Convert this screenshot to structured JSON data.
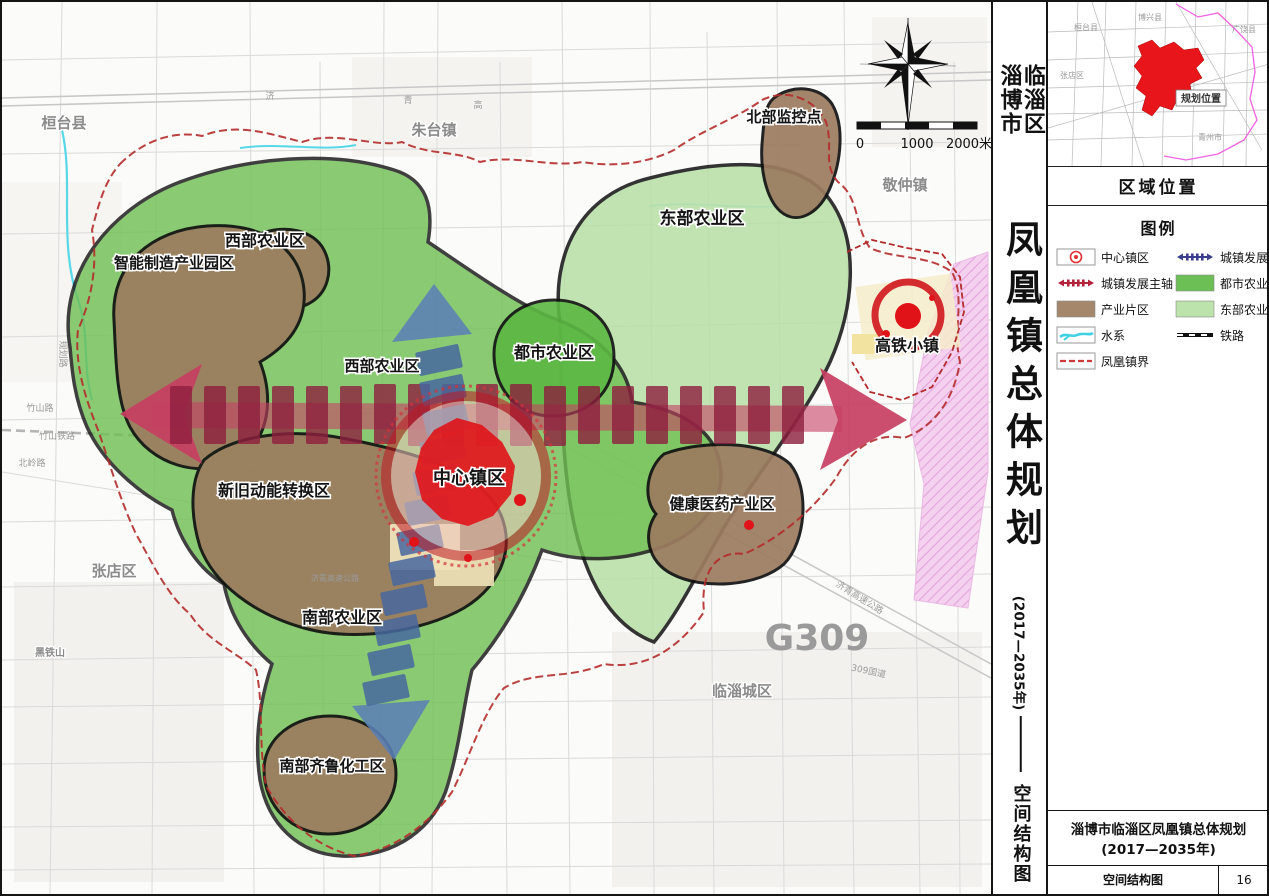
{
  "doc": {
    "region_label_right": "临淄区",
    "region_label_left": "淄博市",
    "main_title": "凤凰镇总体规划",
    "period": "(2017—2035年)",
    "subtitle": "空间结构图"
  },
  "inset": {
    "header": "区域位置",
    "box_label": "规划位置",
    "labels": [
      "桓台县",
      "博兴县",
      "广饶县",
      "张店区",
      "青州市"
    ]
  },
  "legend": {
    "header": "图例",
    "left": [
      {
        "label": "中心镇区",
        "icon": "center-town"
      },
      {
        "label": "城镇发展主轴",
        "icon": "main-axis"
      },
      {
        "label": "产业片区",
        "icon": "industry-zone"
      },
      {
        "label": "水系",
        "icon": "water-system"
      },
      {
        "label": "凤凰镇界",
        "icon": "town-boundary"
      }
    ],
    "right": [
      {
        "label": "城镇发展次轴",
        "icon": "secondary-axis"
      },
      {
        "label": "都市农业区",
        "icon": "urban-agriculture"
      },
      {
        "label": "东部农业区",
        "icon": "east-agriculture"
      },
      {
        "label": "铁路",
        "icon": "railway"
      }
    ]
  },
  "map": {
    "zone_labels": [
      "北部监控点",
      "东部农业区",
      "西部农业区",
      "智能制造产业园区",
      "西部农业区",
      "都市农业区",
      "中心镇区",
      "新旧动能转换区",
      "健康医药产业区",
      "南部农业区",
      "高铁小镇",
      "南部齐鲁化工区"
    ],
    "district_labels": [
      "桓台县",
      "朱台镇",
      "敬仲镇",
      "张店区",
      "临淄城区",
      "黑铁山"
    ],
    "road_labels": [
      "济",
      "青",
      "高",
      "竹山路",
      "竹山铁路",
      "北岭路",
      "规划路",
      "济青高速公路",
      "济青高速公路",
      "G309",
      "309国道"
    ],
    "scale": {
      "zero": "0",
      "mid": "1000",
      "end": "2000米"
    }
  },
  "footer": {
    "title": "淄博市临淄区凤凰镇总体规划(2017—2035年)",
    "map_name": "空间结构图",
    "page": "16"
  },
  "colors": {
    "urban_agriculture": "#6fbf52",
    "east_agriculture": "#b7dfa6",
    "industry_zone": "#9c7c60",
    "main_axis": "#b3243c",
    "secondary_axis": "#3d3d8f",
    "water": "#45d5e5",
    "town_boundary": "#b42b2b",
    "center_town_red": "#e01318",
    "planning_area_red": "#e8151a",
    "pink_zone": "#f3cdee"
  }
}
